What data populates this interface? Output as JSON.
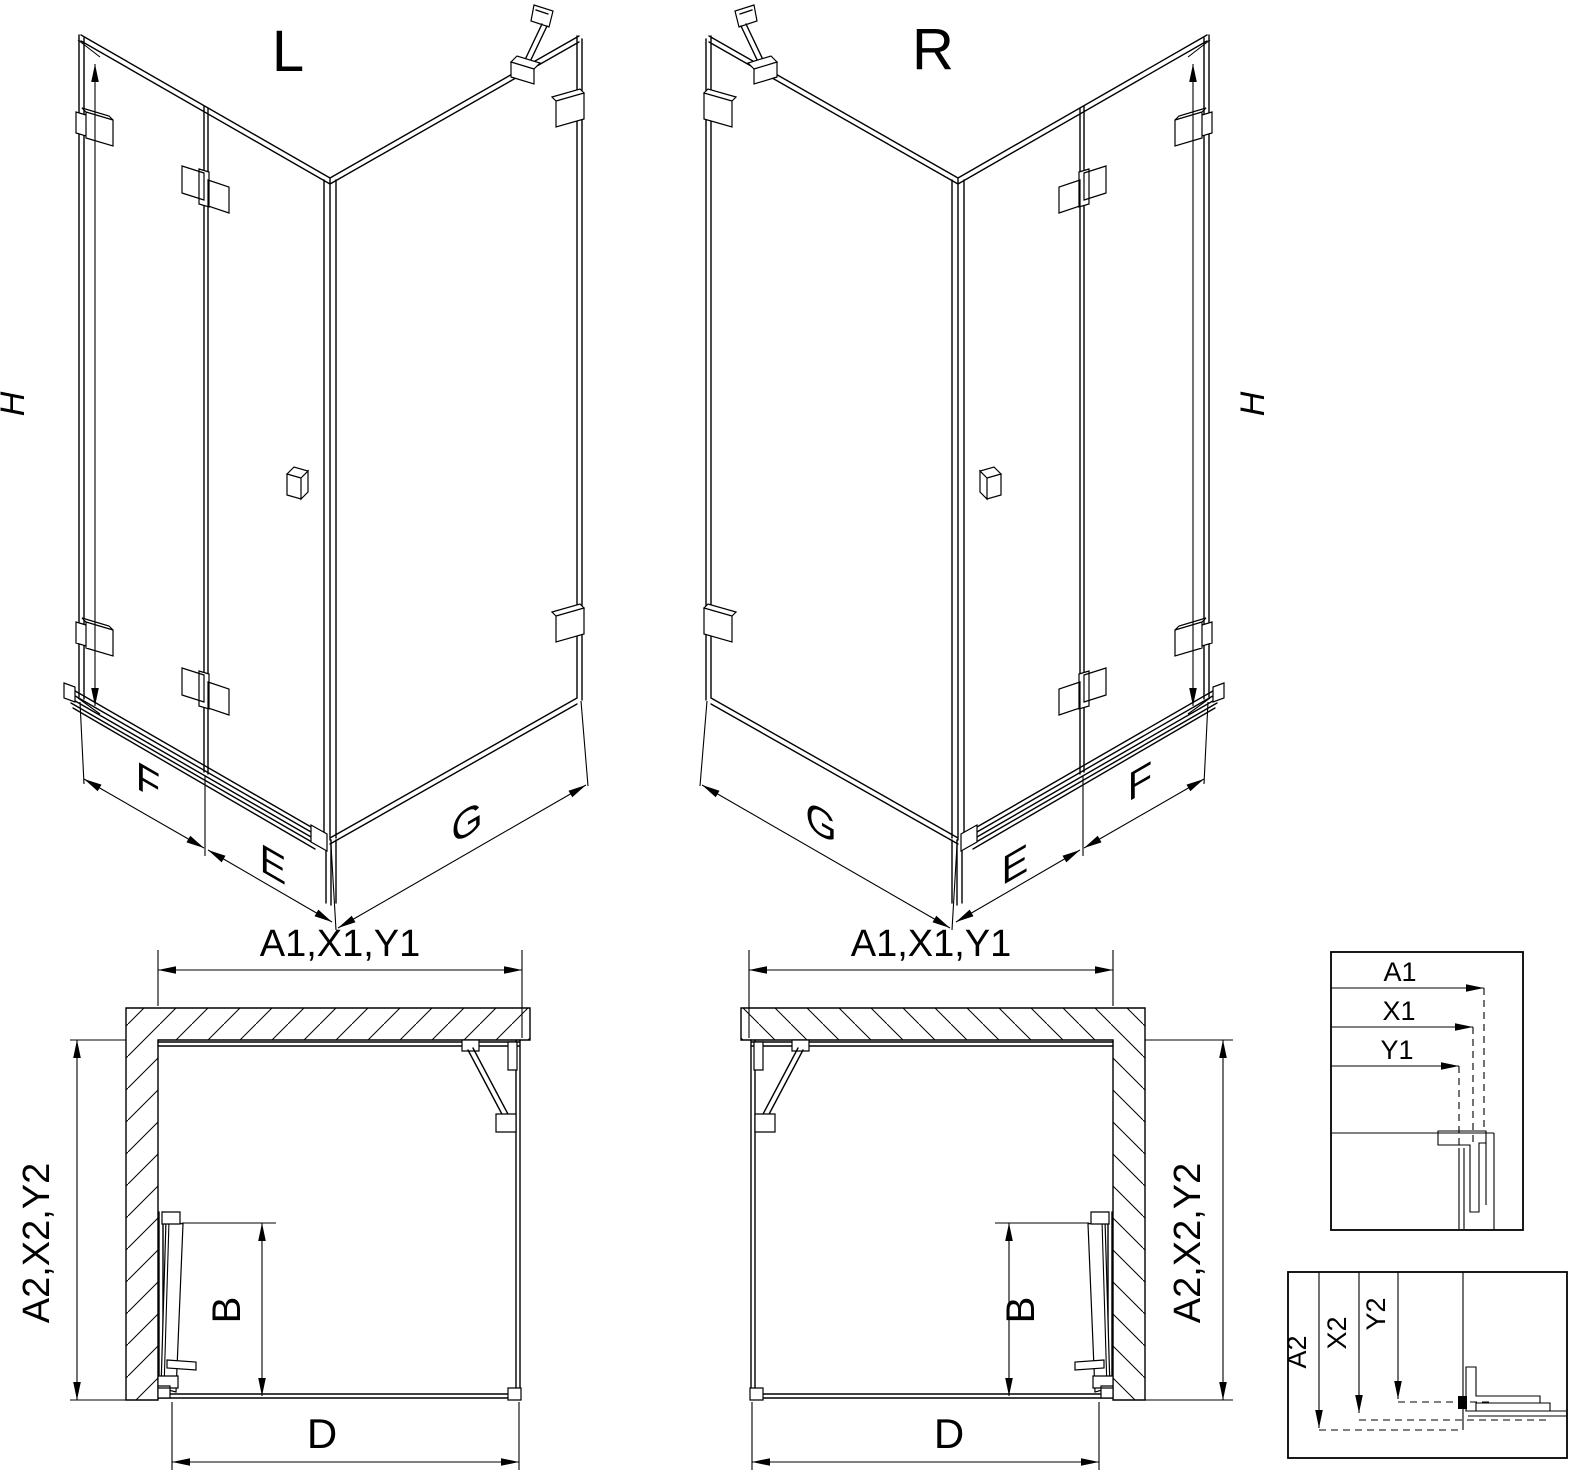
{
  "drawing": {
    "iso_left": {
      "title": "L",
      "height": "H",
      "front_left": "F",
      "front_middle": "E",
      "front_right": "G"
    },
    "iso_right": {
      "title": "R",
      "height": "H",
      "front_left": "G",
      "front_middle": "E",
      "front_right": "F"
    },
    "plan_left": {
      "top": "A1,X1,Y1",
      "side": "A2,X2,Y2",
      "door": "B",
      "entry": "D"
    },
    "plan_right": {
      "top": "A1,X1,Y1",
      "side": "A2,X2,Y2",
      "door": "B",
      "entry": "D"
    },
    "detail_top": {
      "d1": "A1",
      "d2": "X1",
      "d3": "Y1"
    },
    "detail_bottom": {
      "d1": "A2",
      "d2": "X2",
      "d3": "Y2"
    },
    "colors": {
      "line": "#000000",
      "background": "#ffffff"
    }
  }
}
